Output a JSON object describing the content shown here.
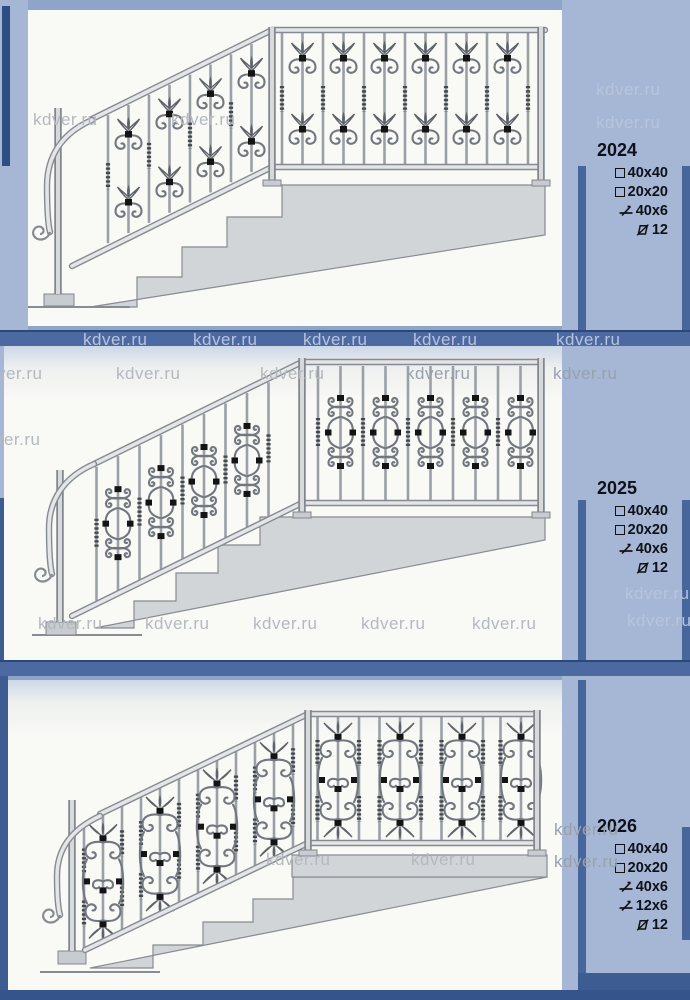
{
  "watermark": "kdver.ru",
  "panels": [
    {
      "code": "2024",
      "drawing": "stair-railing-design-2024",
      "specs": [
        {
          "icon": "square",
          "label": "40x40"
        },
        {
          "icon": "square",
          "label": "20x20"
        },
        {
          "icon": "flat-bar",
          "label": "40x6"
        },
        {
          "icon": "round-bar",
          "label": "12"
        }
      ]
    },
    {
      "code": "2025",
      "drawing": "stair-railing-design-2025",
      "specs": [
        {
          "icon": "square",
          "label": "40x40"
        },
        {
          "icon": "square",
          "label": "20x20"
        },
        {
          "icon": "flat-bar",
          "label": "40x6"
        },
        {
          "icon": "round-bar",
          "label": "12"
        }
      ]
    },
    {
      "code": "2026",
      "drawing": "stair-railing-design-2026",
      "specs": [
        {
          "icon": "square",
          "label": "40x40"
        },
        {
          "icon": "square",
          "label": "20x20"
        },
        {
          "icon": "flat-bar",
          "label": "40x6"
        },
        {
          "icon": "flat-bar",
          "label": "12x6"
        },
        {
          "icon": "round-bar",
          "label": "12"
        }
      ]
    }
  ],
  "colors": {
    "page_blue": "#8da5c9",
    "sidebar_blue": "#a6b7d5",
    "accent_navy": "#46669c",
    "separator_blue": "#4c6aa1",
    "spec_text": "#0e1118",
    "drawing_metal": "#9aa0a6",
    "drawing_steps": "#d2d5d8"
  }
}
